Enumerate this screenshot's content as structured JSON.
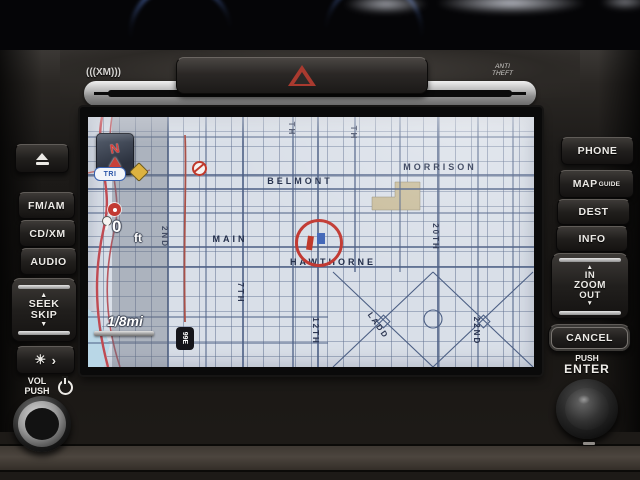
{
  "device": {
    "xm_logo": "(((XM)))",
    "anti_theft": [
      "ANTI",
      "THEFT"
    ],
    "icons": {
      "hazard": "warning-triangle",
      "eject": "eject-triangle-over-bar",
      "power": "power-symbol",
      "brightness": "sun-and-dim"
    }
  },
  "left_panel": {
    "fm_am": "FM/AM",
    "cd_xm": "CD/XM",
    "audio": "AUDIO",
    "seek": {
      "up": "▲",
      "line1": "SEEK",
      "line2": "SKIP",
      "down": "▼"
    },
    "brightness": {
      "sun": "☀",
      "next": "›"
    },
    "vol": {
      "line1": "VOL",
      "line2": "PUSH"
    }
  },
  "right_panel": {
    "phone": "PHONE",
    "map": "MAP",
    "guide": "GUIDE",
    "dest": "DEST",
    "info": "INFO",
    "zoom": {
      "up": "▲",
      "in": "IN",
      "label": "ZOOM",
      "out": "OUT",
      "down": "▼"
    },
    "cancel": "CANCEL",
    "enter": {
      "line1": "PUSH",
      "line2": "ENTER"
    }
  },
  "map": {
    "compass_n": "N",
    "transit_badge": "TRI",
    "distance": {
      "value": "0",
      "unit": "ft"
    },
    "scale": "1/8mi",
    "highway_shield": "99E",
    "streets_horizontal": [
      {
        "name": "BELMONT"
      },
      {
        "name": "MORRISON"
      },
      {
        "name": "MAIN"
      },
      {
        "name": "HAWTHORNE"
      }
    ],
    "streets_vertical": [
      {
        "name": "2ND"
      },
      {
        "name": "7TH"
      },
      {
        "name": "12TH"
      },
      {
        "name": "20TH"
      },
      {
        "name": "22ND"
      }
    ],
    "street_diagonal": "LADD",
    "partial_labels": [
      {
        "name": "TH"
      },
      {
        "name": "TH"
      }
    ],
    "colors": {
      "background": "#d9dfe8",
      "grid": "#5d6e8e",
      "route": "#b34a44",
      "highway": "#c24752",
      "cursor": "#c23a33",
      "water": "#b9d7e7",
      "blocks": "#c9bd9c"
    }
  }
}
